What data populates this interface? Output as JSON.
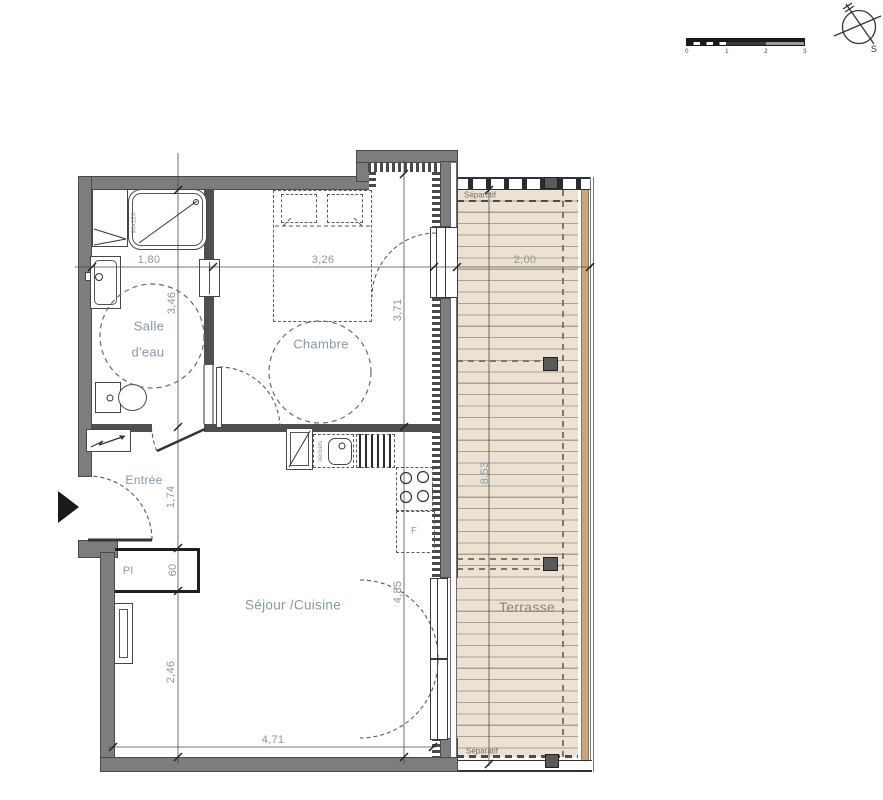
{
  "colors": {
    "wall": "#7d7d7d",
    "partition": "#4f4f4f",
    "line": "#3f3f3f",
    "deck": "#ece2d3",
    "plank": "#b1a087",
    "wood": "#c8a67c",
    "post": "#5a5a5a",
    "label": "#8599a4",
    "sep": "#716e5e",
    "terrace_label": "#8b8577"
  },
  "rooms": {
    "salle_deau_line1": "Salle",
    "salle_deau_line2": "d'eau",
    "chambre": "Chambre",
    "entree": "Entrée",
    "sejour_cuisine": "Séjour /Cuisine",
    "terrasse": "Terrasse",
    "placard": "Pl"
  },
  "dimensions": {
    "bath_width": "1,80",
    "bedroom_width": "3,26",
    "terrace_width": "2,00",
    "bath_depth": "3,46",
    "bedroom_depth": "3,71",
    "hall_depth": "1,74",
    "closet_depth": "60",
    "sejour_left_depth": "2,46",
    "sejour_right_depth": "4,85",
    "sejour_width": "4,71",
    "terrace_length": "8,53"
  },
  "annotations": {
    "separatif_top": "Séparatif",
    "separatif_bottom": "Séparatif",
    "shower_size": "90x120",
    "waste_label": "déchets",
    "fridge_label": "F"
  },
  "scale_bar": {
    "ticks": [
      "0",
      "1",
      "2",
      "3"
    ]
  },
  "compass": {
    "south_label": "S"
  }
}
